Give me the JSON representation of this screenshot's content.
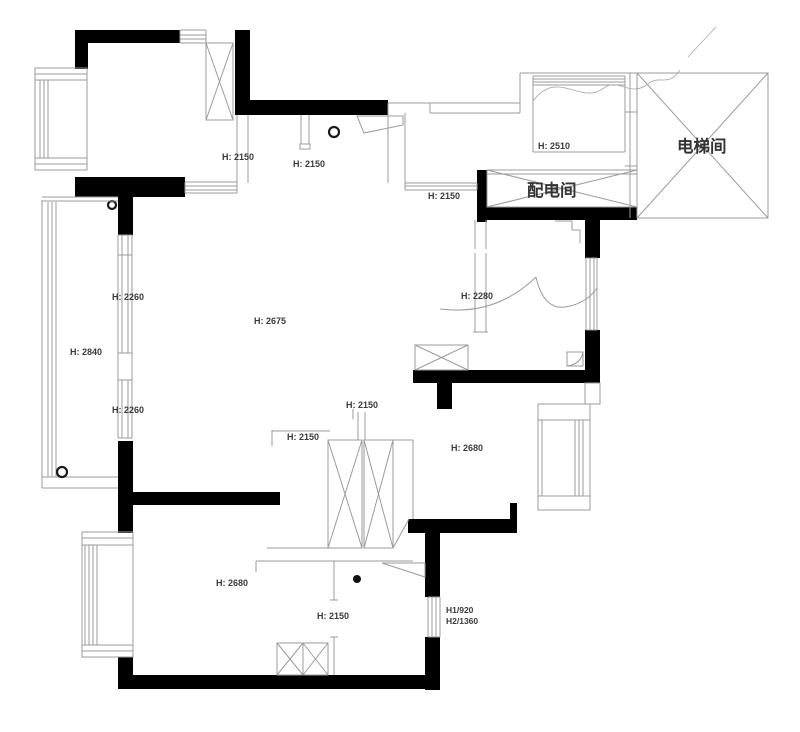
{
  "drawing": {
    "kind": "residential-floor-plan",
    "background": "#ffffff",
    "wall_color": "#000000",
    "line_color": "#9b9b9b",
    "text_color": "#3a3a3a"
  },
  "rooms": [
    {
      "label": "电梯间"
    },
    {
      "label": "配电间"
    }
  ],
  "labels": [
    {
      "text": "H: 2150"
    },
    {
      "text": "H: 2150"
    },
    {
      "text": "H: 2510"
    },
    {
      "text": "电梯间"
    },
    {
      "text": "配电间"
    },
    {
      "text": "H: 2150"
    },
    {
      "text": "H: 2260"
    },
    {
      "text": "H: 2840"
    },
    {
      "text": "H: 2675"
    },
    {
      "text": "H: 2280"
    },
    {
      "text": "H: 2260"
    },
    {
      "text": "H: 2150"
    },
    {
      "text": "H: 2150"
    },
    {
      "text": "H: 2680"
    },
    {
      "text": "H: 2680"
    },
    {
      "text": "H: 2150"
    },
    {
      "text": "H1/920"
    },
    {
      "text": "H2/1360"
    }
  ]
}
